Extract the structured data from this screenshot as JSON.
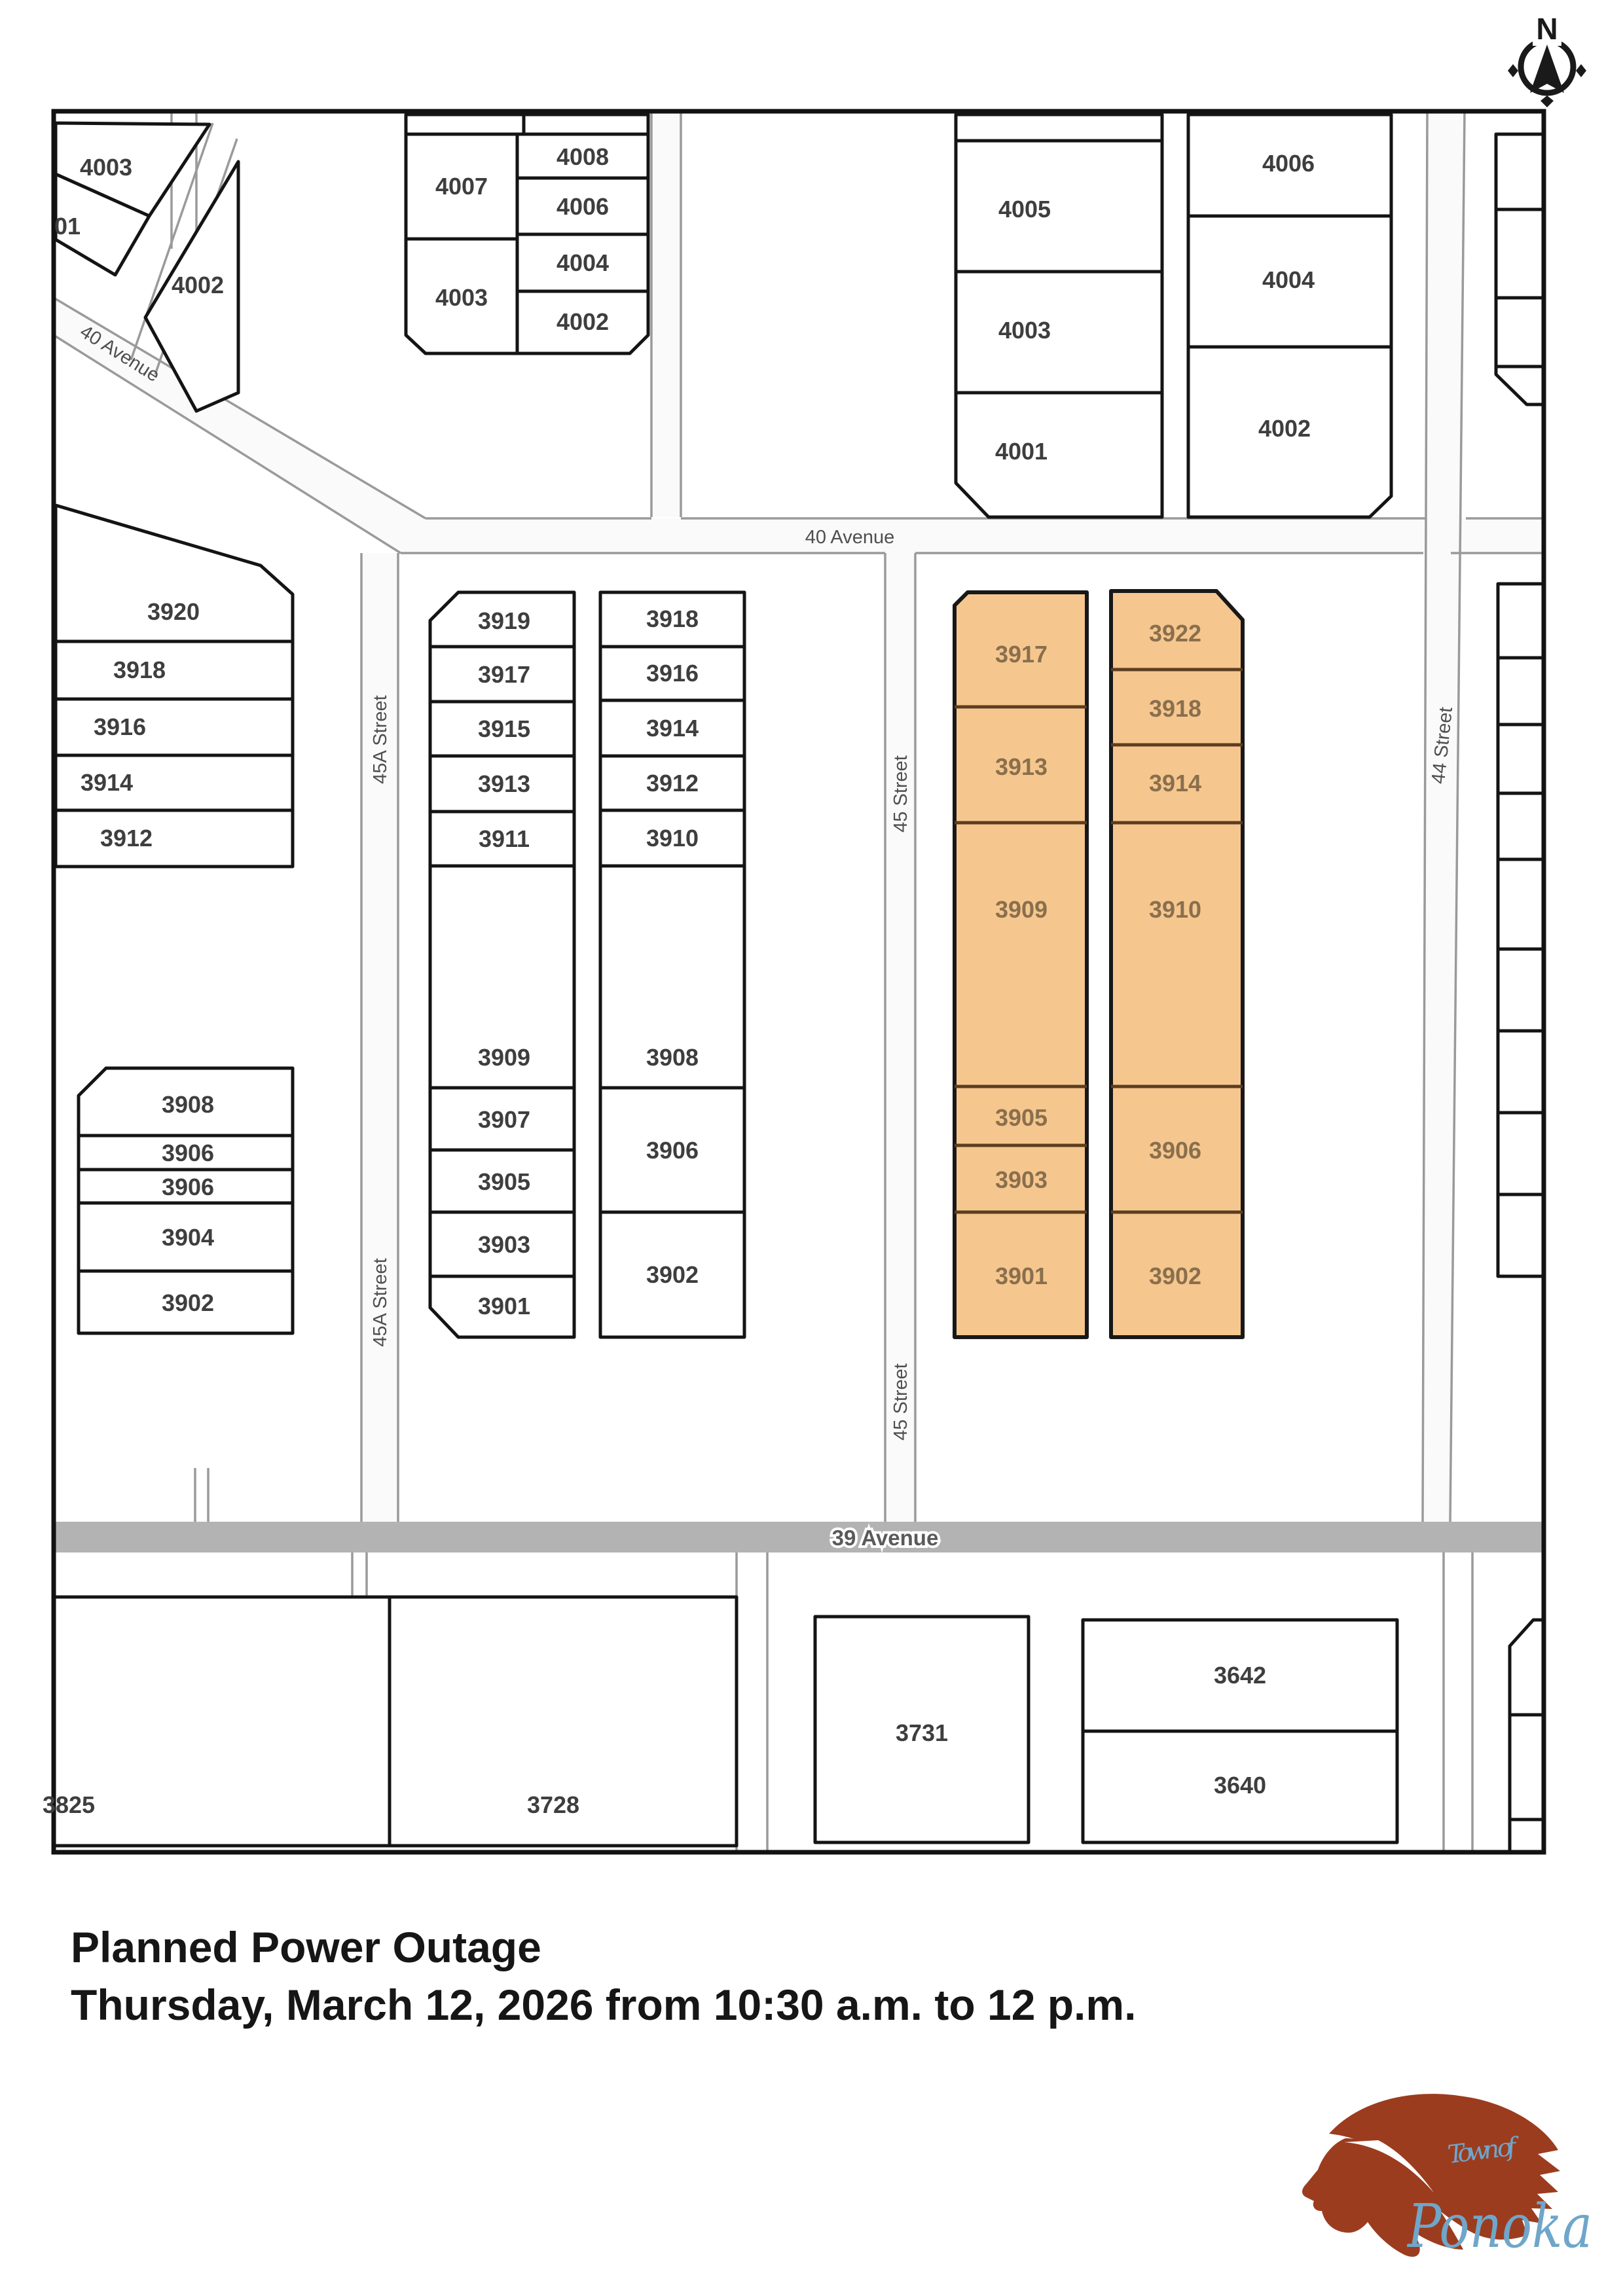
{
  "compass": {
    "label": "N"
  },
  "map": {
    "street_labels": {
      "avenue40": "40 Avenue",
      "avenue39": "39 Avenue",
      "street45a": "45A Street",
      "street45": "45 Street",
      "street44": "44 Street"
    },
    "lots": {
      "top_left": [
        "4003",
        "01",
        "4002"
      ],
      "block_nw_left": [
        "4007",
        "4003"
      ],
      "block_nw_right": [
        "4008",
        "4006",
        "4004",
        "4002"
      ],
      "block_ne_left": [
        "4005",
        "4003",
        "4001"
      ],
      "block_ne_right": [
        "4006",
        "4004",
        "4002"
      ],
      "col_45a_west_upper": [
        "3920",
        "3918",
        "3916",
        "3914",
        "3912"
      ],
      "col_45a_west_lower": [
        "3908",
        "3906",
        "3906",
        "3904",
        "3902"
      ],
      "col_45a_east": [
        "3919",
        "3917",
        "3915",
        "3913",
        "3911",
        "3909",
        "3907",
        "3905",
        "3903",
        "3901"
      ],
      "col_45_west": [
        "3918",
        "3916",
        "3914",
        "3912",
        "3910",
        "3908",
        "3906",
        "3902"
      ],
      "outage_col_west": [
        "3917",
        "3913",
        "3909",
        "3905",
        "3903",
        "3901"
      ],
      "outage_col_east": [
        "3922",
        "3918",
        "3914",
        "3910",
        "3906",
        "3902"
      ],
      "south": [
        "3825",
        "3728",
        "3731",
        "3642",
        "3640"
      ]
    },
    "colors": {
      "outage_highlight": "#F5C78E",
      "outage_divider": "#5C3D21",
      "outage_text": "#8A6F4D",
      "lot_border": "#141414",
      "lot_text": "#3E3E3E",
      "street_line": "#9A9A9A",
      "avenue39_fill": "#B3B3B3"
    }
  },
  "caption": {
    "line1": "Planned Power Outage",
    "line2": "Thursday, March 12, 2026 from 10:30 a.m. to 12 p.m."
  },
  "logo": {
    "tagline": "Town of",
    "name": "Ponoka",
    "horse_color": "#9C3C1F",
    "text_color": "#6FA6CA"
  }
}
